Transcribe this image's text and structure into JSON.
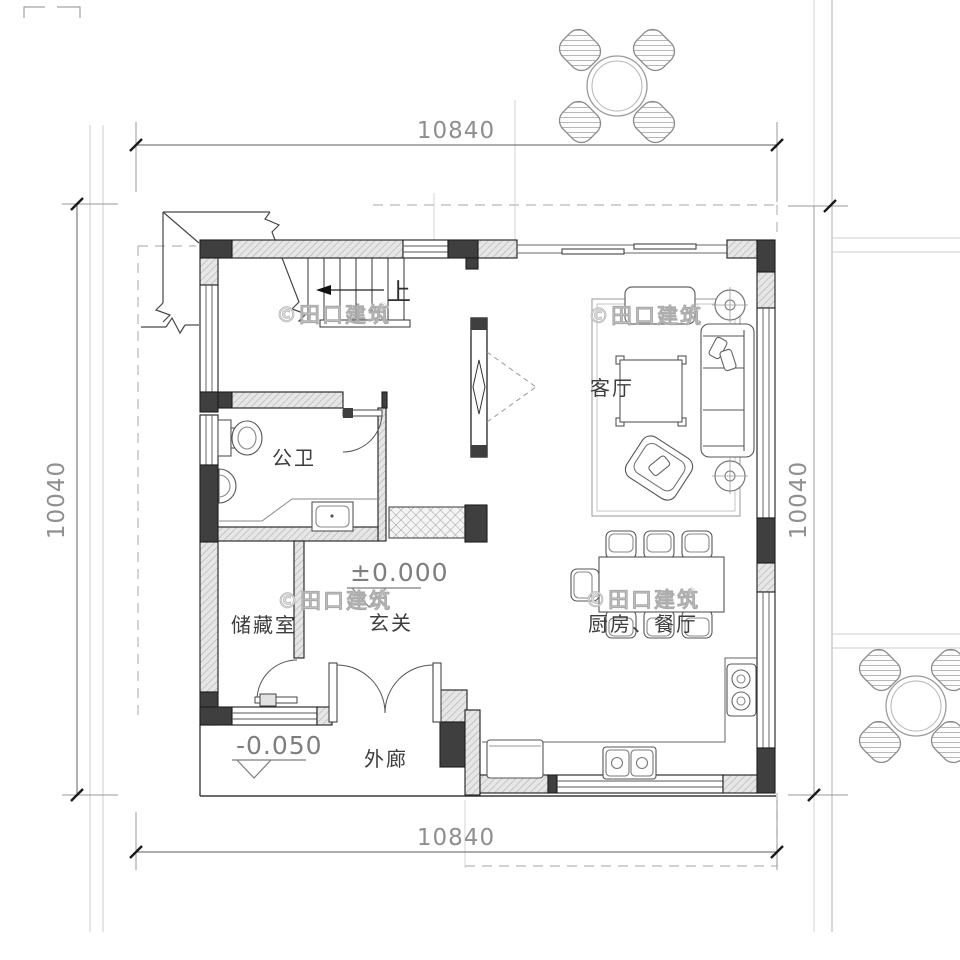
{
  "drawing": {
    "kind": "residential-floor-plan"
  },
  "dimensions": {
    "top": "10840",
    "bottom": "10840",
    "left": "10040",
    "right": "10040"
  },
  "levels": {
    "indoor": "±0.000",
    "porch": "-0.050"
  },
  "rooms": {
    "living": "客厅",
    "bathroom": "公卫",
    "storage": "储藏室",
    "foyer": "玄关",
    "kitchen_dining": "厨房、餐厅",
    "veranda": "外廊"
  },
  "stairs": {
    "up_label": "上"
  },
  "watermark": {
    "text": "©田口建筑",
    "reg": "®"
  },
  "colors": {
    "wall_dark": "#3f3f3f",
    "wall_hatch_bg": "#e6e6e6",
    "line": "#2a2a2a",
    "dim": "#8f8f8f",
    "dashed": "#b8b8b8",
    "site_line": "#cccccc",
    "watermark": "#d8d8d8"
  }
}
